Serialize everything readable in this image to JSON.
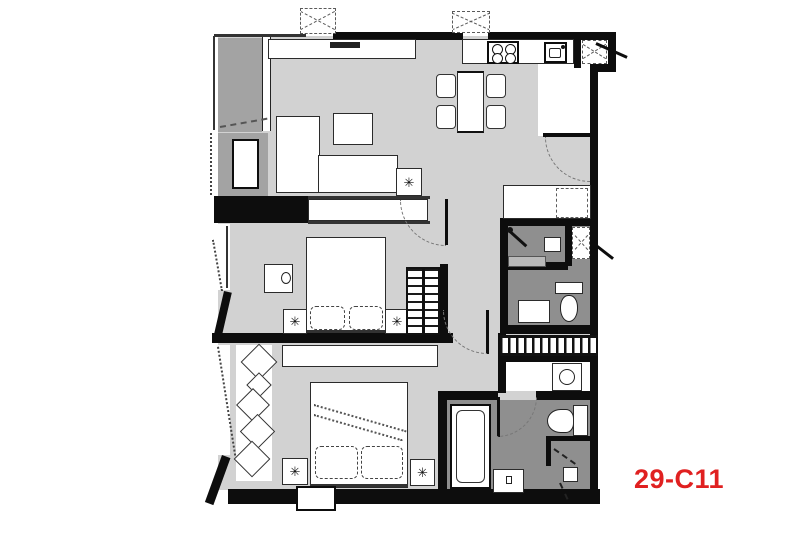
{
  "unit_label": {
    "text": "29-C11"
  },
  "icons": {
    "plant": "✳"
  },
  "palette": {
    "bg": "#ffffff",
    "wall": "#0d0d0d",
    "floor_light": "#d2d2d2",
    "floor_mid": "#a3a3a3",
    "floor_dark": "#8f8f8f",
    "furniture": "#ffffff",
    "line": "#2b2b2b",
    "dash": "#5a5a5a",
    "label_red": "#e02020"
  },
  "depicted": {
    "type": "apartment-floor-plan",
    "rooms": [
      "living-dining",
      "kitchen",
      "bedroom-1",
      "bedroom-2",
      "bathroom-1",
      "bathroom-2",
      "balcony",
      "entry",
      "laundry-ledge"
    ]
  }
}
